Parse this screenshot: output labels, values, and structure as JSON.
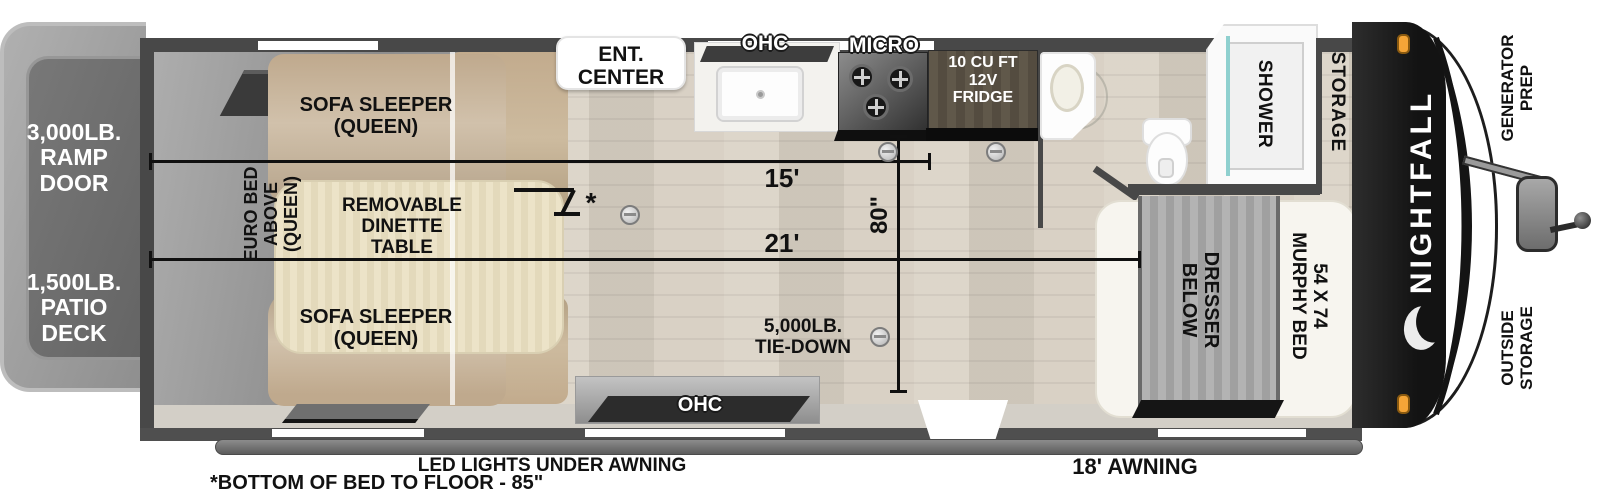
{
  "exterior": {
    "brand": "NIGHTFALL",
    "ramp_door": "3,000LB.\nRAMP DOOR",
    "patio_deck": "1,500LB.\nPATIO DECK",
    "generator_prep": "GENERATOR\nPREP",
    "outside_storage": "OUTSIDE\nSTORAGE",
    "awning": "18' AWNING",
    "led_lights": "LED LIGHTS UNDER AWNING",
    "bed_floor_note": "*BOTTOM OF BED TO FLOOR - 85\""
  },
  "garage": {
    "sofa_sleeper_top": "SOFA SLEEPER\n(QUEEN)",
    "sofa_sleeper_bottom": "SOFA SLEEPER\n(QUEEN)",
    "euro_bed": "EURO BED\nABOVE\n(QUEEN)",
    "dinette": "REMOVABLE\nDINETTE\nTABLE",
    "bed_height_marker": "*"
  },
  "kitchen": {
    "ent_center": "ENT.\nCENTER",
    "ohc_top": "OHC",
    "micro": "MICRO",
    "fridge": "10 CU FT\n12V\nFRIDGE",
    "ohc_bottom": "OHC"
  },
  "bath": {
    "shower": "SHOWER",
    "storage": "STORAGE"
  },
  "bedroom": {
    "murphy_bed": "54 X 74\nMURPHY BED",
    "dresser": "DRESSER\nBELOW"
  },
  "dimensions": {
    "garage_length": "15'",
    "interior_length": "21'",
    "width": "80\"",
    "tie_down": "5,000LB.\nTIE-DOWN"
  },
  "colors": {
    "wall": "#4a4a4a",
    "front_cap": "#1a1a1a",
    "marker_light": "#f5a537",
    "sofa_tan": "#c6b096",
    "table_cream": "#e9e0c4",
    "floor_wood": "#d8d0c3",
    "platform_gray": "#9c9c9c",
    "dimension_line": "#101010",
    "shower_glass": "#8fd0cf"
  }
}
